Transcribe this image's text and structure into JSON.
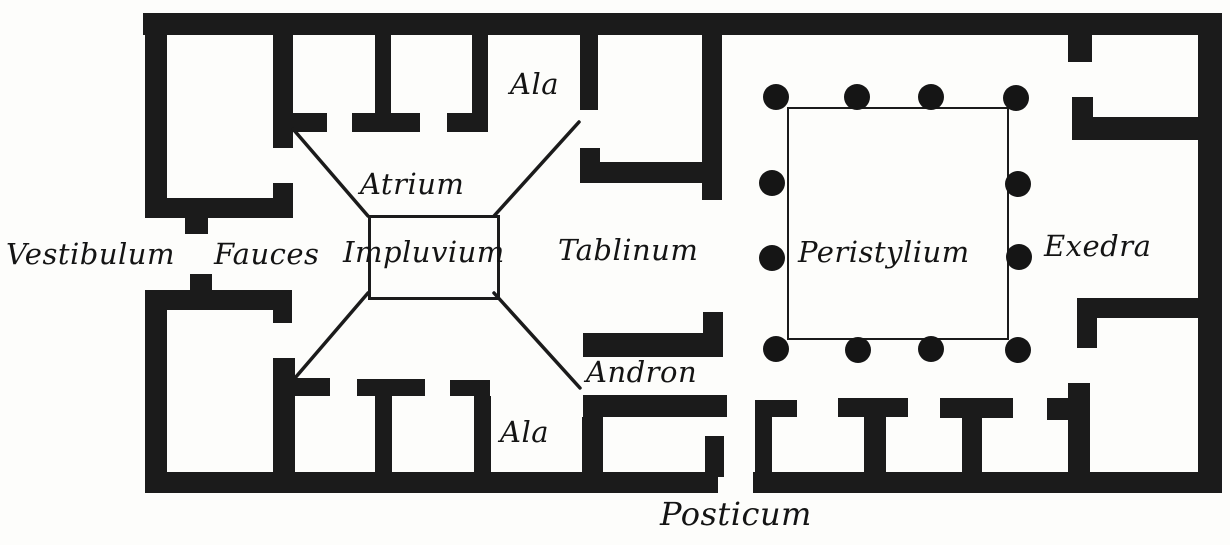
{
  "colors": {
    "ink": "#1b1b1b",
    "paper": "#fdfdfb"
  },
  "plan": {
    "rooms": {
      "vestibulum": "Vestibulum",
      "fauces": "Fauces",
      "atrium": "Atrium",
      "impluvium": "Impluvium",
      "ala_top": "Ala",
      "ala_bottom": "Ala",
      "tablinum": "Tablinum",
      "andron": "Andron",
      "peristylium": "Peristylium",
      "exedra": "Exedra",
      "posticum": "Posticum"
    }
  }
}
